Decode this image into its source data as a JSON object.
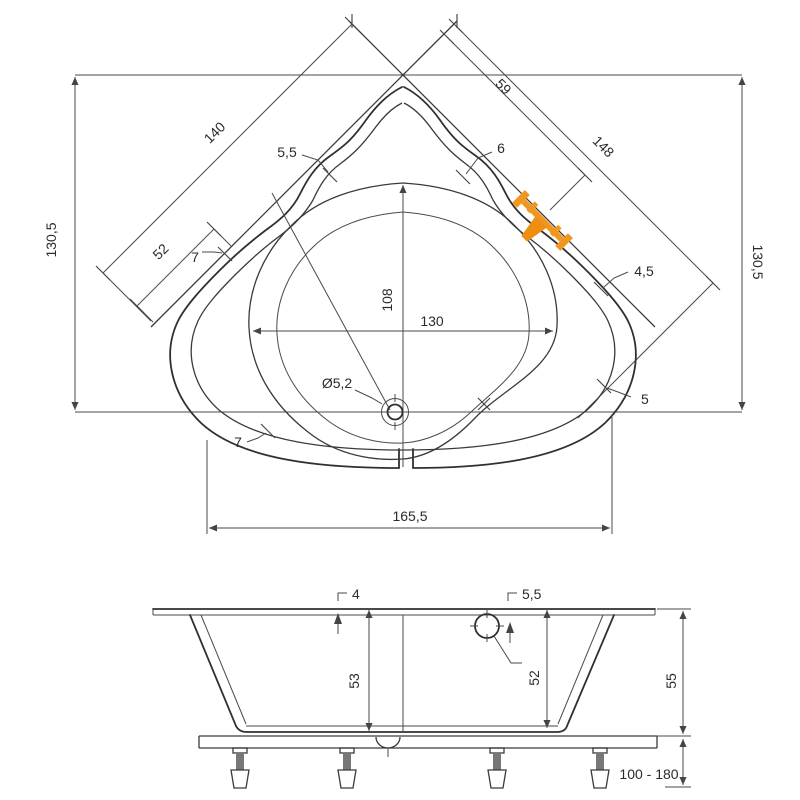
{
  "colors": {
    "line": "#3d3d3d",
    "text": "#2b2b2b",
    "accent": "#F0971F",
    "background": "#ffffff"
  },
  "top_view": {
    "dims": {
      "width_total_left": "130,5",
      "width_total_right": "130,5",
      "edge_left": "140",
      "edge_left_partial": "52",
      "edge_right": "148",
      "edge_right_partial": "59",
      "rim_55": "5,5",
      "rim_6": "6",
      "rim_7_left": "7",
      "rim_7_bottom": "7",
      "rim_45": "4,5",
      "rim_5": "5",
      "basin_height": "108",
      "basin_width": "130",
      "drain_diameter": "Ø5,2",
      "front_width": "165,5"
    }
  },
  "side_view": {
    "dims": {
      "rim_4": "4",
      "rim_55": "5,5",
      "depth_53": "53",
      "depth_52": "52",
      "height_55": "55",
      "leg_range": "100 - 180"
    }
  }
}
